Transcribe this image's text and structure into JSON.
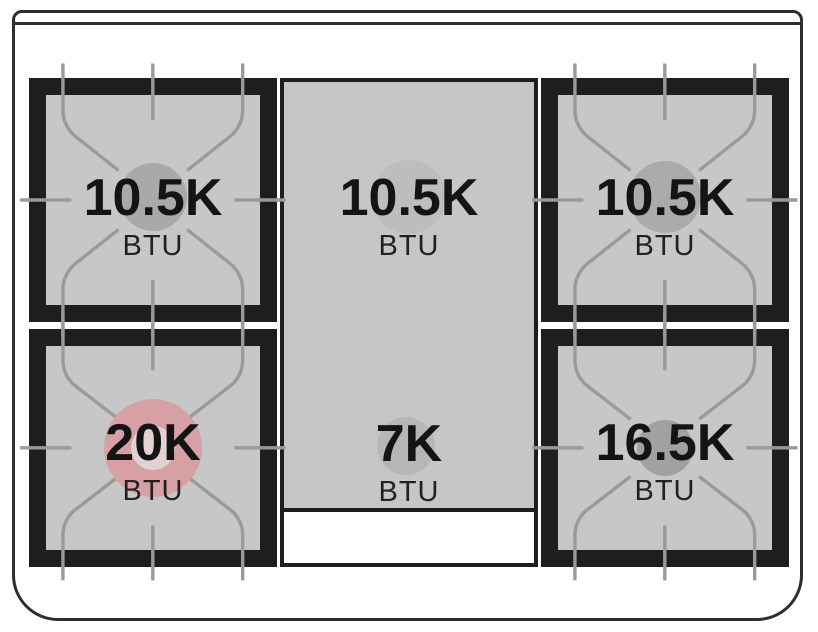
{
  "cooktop": {
    "description": "gas range cooktop burner BTU layout diagram",
    "burners": [
      {
        "id": "top-left",
        "value": "10.5K",
        "unit": "BTU"
      },
      {
        "id": "top-center",
        "value": "10.5K",
        "unit": "BTU"
      },
      {
        "id": "top-right",
        "value": "10.5K",
        "unit": "BTU"
      },
      {
        "id": "bottom-left",
        "value": "20K",
        "unit": "BTU",
        "highlighted": true
      },
      {
        "id": "bottom-center",
        "value": "7K",
        "unit": "BTU"
      },
      {
        "id": "bottom-right",
        "value": "16.5K",
        "unit": "BTU"
      }
    ],
    "colors": {
      "outline": "#2e2e2e",
      "frame_black": "#1e1e1e",
      "plate_gray": "#c7c7c7",
      "grate_line": "#9a9a9a",
      "circle_top_left": "#a9a9a9",
      "circle_top_center": "#bdbdbd",
      "circle_top_right": "#ababab",
      "circle_bottom_left": "#d7a0a5",
      "circle_bottom_left_hole": "#e3d2d3",
      "circle_bottom_center": "#b6b6b6",
      "circle_bottom_right": "#a1a1a1"
    }
  }
}
